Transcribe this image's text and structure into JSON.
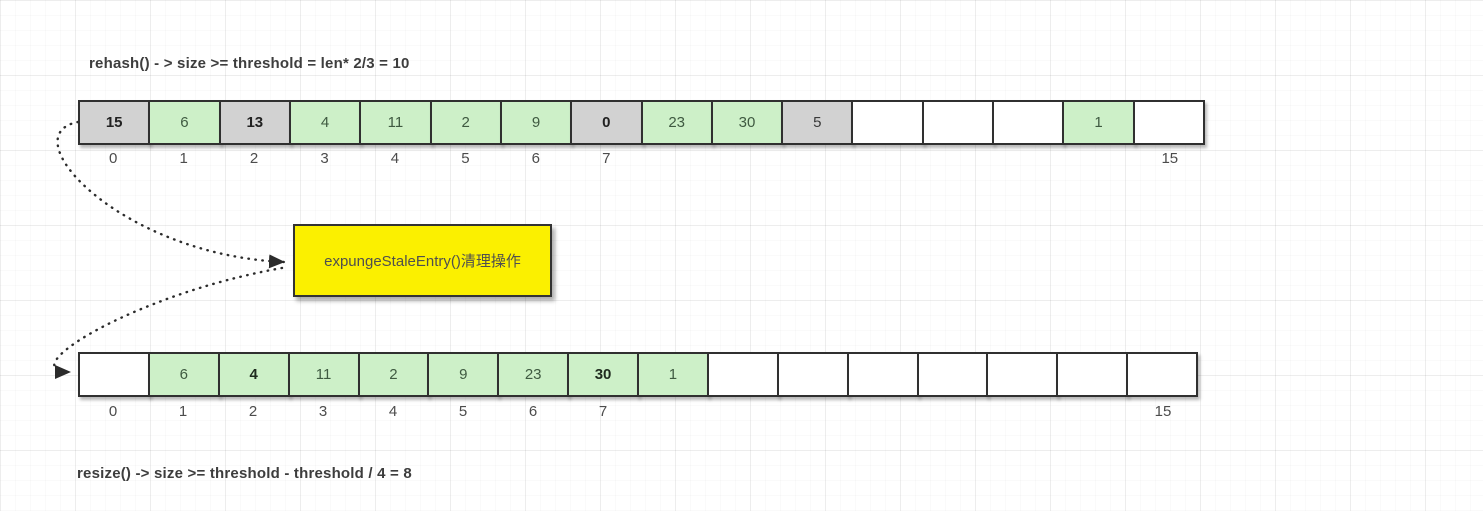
{
  "annotations": {
    "top_formula": "rehash() - > size >= threshold = len* 2/3 = 10",
    "bottom_formula": "resize() -> size >= threshold - threshold / 4 = 8"
  },
  "process_box": {
    "label": "expungeStaleEntry()清理操作",
    "fill_color": "#fbf000"
  },
  "colors": {
    "live_cell_fill": "#cdf0c8",
    "stale_cell_fill": "#d2d2d2",
    "empty_cell_fill": "#ffffff",
    "cell_border": "#303030",
    "connector": "#2b2b2b"
  },
  "arrays": {
    "top": {
      "name": "table-before-rehash",
      "cells": [
        {
          "value": "15",
          "state": "stale",
          "bold": true
        },
        {
          "value": "6",
          "state": "live",
          "bold": false
        },
        {
          "value": "13",
          "state": "stale",
          "bold": true
        },
        {
          "value": "4",
          "state": "live",
          "bold": false
        },
        {
          "value": "11",
          "state": "live",
          "bold": false
        },
        {
          "value": "2",
          "state": "live",
          "bold": false
        },
        {
          "value": "9",
          "state": "live",
          "bold": false
        },
        {
          "value": "0",
          "state": "stale",
          "bold": true
        },
        {
          "value": "23",
          "state": "live",
          "bold": false
        },
        {
          "value": "30",
          "state": "live",
          "bold": false
        },
        {
          "value": "5",
          "state": "stale",
          "bold": false
        },
        {
          "value": "",
          "state": "empty",
          "bold": false
        },
        {
          "value": "",
          "state": "empty",
          "bold": false
        },
        {
          "value": "",
          "state": "empty",
          "bold": false
        },
        {
          "value": "1",
          "state": "live",
          "bold": false
        },
        {
          "value": "",
          "state": "empty",
          "bold": false
        }
      ],
      "index_labels": [
        {
          "position": 0,
          "label": "0"
        },
        {
          "position": 1,
          "label": "1"
        },
        {
          "position": 2,
          "label": "2"
        },
        {
          "position": 3,
          "label": "3"
        },
        {
          "position": 4,
          "label": "4"
        },
        {
          "position": 5,
          "label": "5"
        },
        {
          "position": 6,
          "label": "6"
        },
        {
          "position": 7,
          "label": "7"
        },
        {
          "position": 15,
          "label": "15"
        }
      ]
    },
    "bottom": {
      "name": "table-after-expunge",
      "cells": [
        {
          "value": "",
          "state": "empty",
          "bold": false
        },
        {
          "value": "6",
          "state": "live",
          "bold": false
        },
        {
          "value": "4",
          "state": "live",
          "bold": true
        },
        {
          "value": "11",
          "state": "live",
          "bold": false
        },
        {
          "value": "2",
          "state": "live",
          "bold": false
        },
        {
          "value": "9",
          "state": "live",
          "bold": false
        },
        {
          "value": "23",
          "state": "live",
          "bold": false
        },
        {
          "value": "30",
          "state": "live",
          "bold": true
        },
        {
          "value": "1",
          "state": "live",
          "bold": false
        },
        {
          "value": "",
          "state": "empty",
          "bold": false
        },
        {
          "value": "",
          "state": "empty",
          "bold": false
        },
        {
          "value": "",
          "state": "empty",
          "bold": false
        },
        {
          "value": "",
          "state": "empty",
          "bold": false
        },
        {
          "value": "",
          "state": "empty",
          "bold": false
        },
        {
          "value": "",
          "state": "empty",
          "bold": false
        },
        {
          "value": "",
          "state": "empty",
          "bold": false
        }
      ],
      "index_labels": [
        {
          "position": 0,
          "label": "0"
        },
        {
          "position": 1,
          "label": "1"
        },
        {
          "position": 2,
          "label": "2"
        },
        {
          "position": 3,
          "label": "3"
        },
        {
          "position": 4,
          "label": "4"
        },
        {
          "position": 5,
          "label": "5"
        },
        {
          "position": 6,
          "label": "6"
        },
        {
          "position": 7,
          "label": "7"
        },
        {
          "position": 15,
          "label": "15"
        }
      ]
    }
  }
}
